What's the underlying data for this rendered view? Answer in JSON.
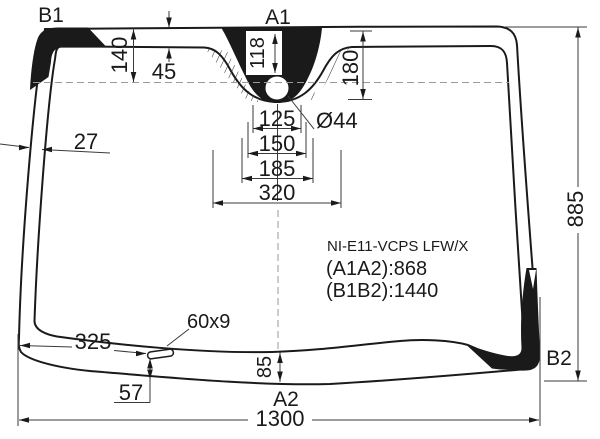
{
  "diagram": {
    "part_code": "NI-E11-VCPS LFW/X",
    "spec_a1a2": "(A1A2):868",
    "spec_b1b2": "(B1B2):1440",
    "labels": {
      "top_left": "B1",
      "top_center": "A1",
      "bottom_center": "A2",
      "bottom_right": "B2"
    },
    "dimensions": {
      "top_band_height": "140",
      "top_band_width": "45",
      "sensor_center_offset": "118",
      "left_band_width": "27",
      "sensor_area_height": "180",
      "hole_diameter": "Ø44",
      "bracket_width_1": "125",
      "bracket_width_2": "150",
      "bracket_width_3": "185",
      "bracket_width_4": "320",
      "height_right": "885",
      "slot_from_left": "325",
      "slot_size": "60x9",
      "slot_from_bottom": "57",
      "bottom_band_height": "85",
      "width_bottom": "1300"
    },
    "colors": {
      "ink": "#1a1a1a",
      "background": "#ffffff",
      "dim_line": "#3a3a3a",
      "centerline": "#9a9a9a"
    }
  }
}
